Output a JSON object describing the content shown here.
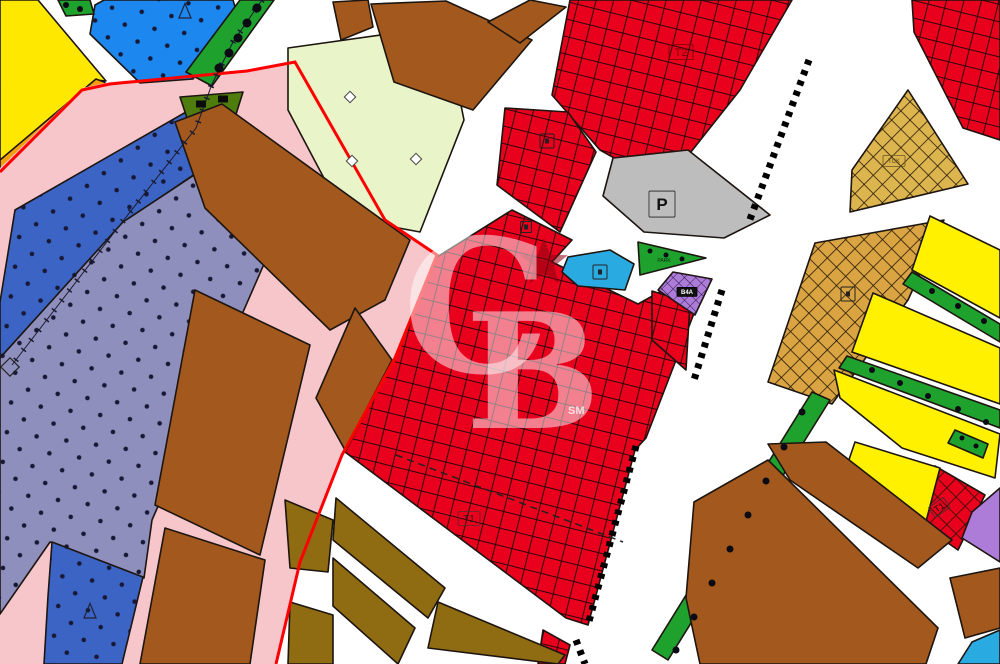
{
  "colors": {
    "road": "#ffffff",
    "outline": "#1d1510",
    "yellow": "#ffe800",
    "orange": "#f59e0b",
    "pinkzone": "#f6c6cb",
    "redline": "#ff0000",
    "blue1": "#1b87ef",
    "blue2": "#3b64c4",
    "slate": "#8f8fbe",
    "cream": "#e9f4c9",
    "brown": "#a3591d",
    "olive": "#8f6b12",
    "red": "#e8001c",
    "gray": "#bdbdbd",
    "gold": "#ddb54f",
    "tan": "#d9a441",
    "yellow2": "#fff100",
    "green": "#1fa12e",
    "dgreen": "#4e7d0e",
    "purple": "#ac7cd8",
    "cyan": "#29abe2",
    "dot": "#181835",
    "watermark": "#ffffff",
    "star": "#8a0012"
  },
  "watermark": {
    "c": "C",
    "b": "B",
    "sm": "SM"
  },
  "map": {
    "width": 1000,
    "height": 664,
    "parcels": [
      {
        "name": "parcel-yellow-nw",
        "color": "yellow",
        "points": "0,0 38,0 106,81 96,80 0,161"
      },
      {
        "name": "parcel-orange-strip",
        "color": "orange",
        "points": "104,82 108,86 8,168 0,170 0,160 96,79"
      },
      {
        "name": "parcel-pink-subject-zone",
        "color": "pinkzone",
        "stroke": "none",
        "points": "0,168 82,88 110,82 247,70 295,60 385,220 437,255 395,358 342,455 300,562 276,664 0,664"
      },
      {
        "name": "parcel-blue-dotted-north",
        "color": "blue1",
        "pattern": "dots",
        "points": "95,5 104,0 233,0 238,17 193,79 140,83 90,34"
      },
      {
        "name": "parcel-blue-dotted-band",
        "color": "blue2",
        "pattern": "dots",
        "points": "15,210 193,108 230,150 123,223 0,358 0,302"
      },
      {
        "name": "parcel-slate-dotted-zone",
        "color": "slate",
        "pattern": "dots",
        "points": "123,222 232,150 292,200 152,520 144,578 50,542 0,614 0,358"
      },
      {
        "name": "parcel-blue-dotted-south",
        "color": "blue2",
        "pattern": "dots",
        "points": "52,542 143,577 122,664 44,664 48,596"
      },
      {
        "name": "green-strip-nw-small",
        "color": "green",
        "points": "58,0 90,0 94,14 66,16"
      },
      {
        "name": "green-strip-nw",
        "color": "green",
        "points": "240,0 274,0 212,86 186,72"
      },
      {
        "name": "parcel-darkgreen-triangle",
        "color": "dgreen",
        "points": "180,97 243,92 232,127 188,121"
      },
      {
        "name": "parcel-cream",
        "color": "cream",
        "points": "288,48 445,26 464,120 420,232 345,218 288,110"
      },
      {
        "name": "parcel-brown-top-1",
        "color": "brown",
        "points": "333,2 368,0 373,27 341,40"
      },
      {
        "name": "parcel-brown-top-2",
        "color": "brown",
        "points": "371,4 446,1 532,40 473,110 394,82"
      },
      {
        "name": "parcel-brown-top-3",
        "color": "brown",
        "points": "530,0 566,7 520,43 488,22"
      },
      {
        "name": "parcel-brown-mid-1",
        "color": "brown",
        "points": "175,122 222,104 410,240 385,300 330,330 205,208"
      },
      {
        "name": "parcel-brown-mid-2",
        "color": "brown",
        "points": "195,290 310,345 260,555 155,505"
      },
      {
        "name": "parcel-brown-mid-3",
        "color": "brown",
        "points": "355,308 392,360 345,450 316,398"
      },
      {
        "name": "parcel-brown-mid-4",
        "color": "brown",
        "points": "165,528 265,560 250,664 140,664"
      },
      {
        "name": "parcel-red-commercial-t2",
        "color": "red",
        "pattern": "xred",
        "points": "570,0 792,0 740,90 664,186 600,150 552,95"
      },
      {
        "name": "parcel-red-commercial-ne",
        "color": "red",
        "pattern": "xred",
        "points": "912,0 1000,0 1000,140 963,128 914,32"
      },
      {
        "name": "parcel-red-commercial-c",
        "color": "red",
        "pattern": "xred",
        "points": "505,108 568,112 596,152 560,232 497,185"
      },
      {
        "name": "parcel-red-commercial-t1",
        "color": "red",
        "pattern": "xred",
        "points": "437,257 512,210 572,240 552,262 638,304 674,284 698,303 646,438 635,450 588,625 566,618 345,452 395,358"
      },
      {
        "name": "parcel-red-south-sliver",
        "color": "red",
        "pattern": "xred",
        "points": "543,630 570,645 565,664 538,664"
      },
      {
        "name": "parcel-red-east-small",
        "color": "red",
        "pattern": "xred",
        "points": "652,291 690,303 686,370 652,340"
      },
      {
        "name": "parcel-red-t1-triangle",
        "color": "red",
        "pattern": "xgold",
        "points": "935,466 985,495 958,550 915,520"
      },
      {
        "name": "parcel-gray-parking",
        "color": "gray",
        "points": "613,158 688,150 770,215 724,238 644,232 603,196"
      },
      {
        "name": "parcel-cyan-facility",
        "color": "cyan",
        "points": "568,257 610,250 634,264 625,290 578,286 562,272"
      },
      {
        "name": "parcel-green-park-triangle",
        "color": "green",
        "points": "638,242 706,258 640,275"
      },
      {
        "name": "parcel-purple-b4a",
        "color": "purple",
        "pattern": "xpurple",
        "points": "673,272 712,279 695,315 658,290"
      },
      {
        "name": "parcel-gold-tck",
        "color": "gold",
        "pattern": "xgold",
        "points": "908,90 968,184 850,212 852,170"
      },
      {
        "name": "parcel-tan-large",
        "color": "tan",
        "pattern": "xgold",
        "points": "815,243 944,220 908,300 832,404 768,382"
      },
      {
        "name": "parcel-yellow-east-1",
        "color": "yellow2",
        "points": "930,216 1000,250 1000,318 912,270"
      },
      {
        "name": "green-strip-e1",
        "color": "green",
        "points": "912,272 1000,324 1000,342 903,284"
      },
      {
        "name": "parcel-yellow-east-2",
        "color": "yellow2",
        "points": "873,293 1000,348 1000,404 852,352"
      },
      {
        "name": "green-strip-e2",
        "color": "green",
        "points": "847,356 1000,410 1000,428 839,368"
      },
      {
        "name": "parcel-yellow-east-3",
        "color": "yellow2",
        "points": "834,370 1000,434 995,478 902,448 840,398"
      },
      {
        "name": "green-strip-e3",
        "color": "green",
        "points": "955,430 988,444 983,458 948,443"
      },
      {
        "name": "parcel-yellow-east-4",
        "color": "yellow2",
        "points": "855,442 940,468 918,552 836,498"
      },
      {
        "name": "parcel-purple-east",
        "color": "purple",
        "points": "972,512 1000,488 1000,562 962,538"
      },
      {
        "name": "green-strip-long",
        "color": "green",
        "points": "812,392 830,400 668,660 652,650"
      },
      {
        "name": "parcel-brown-se-1",
        "color": "brown",
        "points": "768,444 826,442 952,540 918,568 790,480"
      },
      {
        "name": "parcel-brown-se-2",
        "color": "brown",
        "points": "694,502 768,460 938,628 926,664 700,664 686,598"
      },
      {
        "name": "parcel-brown-se-3",
        "color": "brown",
        "points": "950,578 1000,568 1000,628 965,638"
      },
      {
        "name": "parcel-cyan-corner",
        "color": "cyan",
        "points": "972,642 1000,630 1000,664 958,664"
      },
      {
        "name": "parcel-olive-s-1",
        "color": "olive",
        "points": "285,500 333,520 328,572 290,568"
      },
      {
        "name": "parcel-olive-s-2",
        "color": "olive",
        "points": "290,602 333,615 333,664 288,664"
      },
      {
        "name": "parcel-olive-s-3",
        "color": "olive",
        "points": "336,498 445,588 428,618 333,540"
      },
      {
        "name": "parcel-olive-s-4",
        "color": "olive",
        "points": "333,558 415,628 398,664 333,606"
      },
      {
        "name": "parcel-olive-s-5",
        "color": "olive",
        "points": "438,602 565,655 558,664 428,648"
      }
    ],
    "lines": [
      {
        "name": "plan-boundary-red",
        "color": "redline",
        "width": 3,
        "points": [
          [
            0,
            172
          ],
          [
            82,
            90
          ],
          [
            110,
            84
          ],
          [
            247,
            71
          ],
          [
            295,
            62
          ],
          [
            385,
            220
          ],
          [
            437,
            255
          ],
          [
            395,
            358
          ],
          [
            342,
            455
          ],
          [
            300,
            562
          ],
          [
            276,
            664
          ]
        ]
      },
      {
        "name": "transmission-line",
        "color": "#1a1a2e",
        "width": 1,
        "tick": true,
        "points": [
          [
            262,
            0
          ],
          [
            233,
            42
          ],
          [
            212,
            84
          ],
          [
            196,
            128
          ],
          [
            123,
            221
          ],
          [
            12,
            365
          ]
        ]
      },
      {
        "name": "ladder-road-1",
        "color": "#000000",
        "width": 7,
        "dash": "5,6",
        "points": [
          [
            809,
            60
          ],
          [
            749,
            222
          ]
        ]
      },
      {
        "name": "ladder-road-1b",
        "color": "#000000",
        "width": 7,
        "dash": "5,6",
        "points": [
          [
            722,
            290
          ],
          [
            694,
            380
          ]
        ]
      },
      {
        "name": "ladder-road-2",
        "color": "#000000",
        "width": 7,
        "dash": "5,6",
        "points": [
          [
            636,
            446
          ],
          [
            588,
            625
          ]
        ]
      },
      {
        "name": "ladder-road-2b",
        "color": "#000000",
        "width": 7,
        "dash": "5,6",
        "points": [
          [
            576,
            640
          ],
          [
            585,
            664
          ]
        ]
      },
      {
        "name": "dashed-parcel-line",
        "color": "#222222",
        "width": 1.5,
        "dash": "7,5",
        "points": [
          [
            396,
            455
          ],
          [
            623,
            542
          ]
        ]
      }
    ],
    "symbols": [
      {
        "name": "facility-box-icon",
        "type": "box",
        "x": 547,
        "y": 141,
        "s": 14
      },
      {
        "name": "facility-box-icon",
        "type": "box",
        "x": 600,
        "y": 272,
        "s": 14
      },
      {
        "name": "facility-box-icon",
        "type": "box",
        "x": 848,
        "y": 294,
        "s": 14
      },
      {
        "name": "facility-box-icon",
        "type": "box",
        "x": 526,
        "y": 227,
        "s": 11
      },
      {
        "name": "diamond-marker",
        "type": "diamond",
        "x": 350,
        "y": 97,
        "s": 8
      },
      {
        "name": "diamond-marker",
        "type": "diamond",
        "x": 416,
        "y": 159,
        "s": 8
      },
      {
        "name": "diamond-marker",
        "type": "diamond",
        "x": 352,
        "y": 161,
        "s": 8
      },
      {
        "name": "diamond-outline-marker",
        "type": "diamond-outline",
        "x": 10,
        "y": 367,
        "s": 13
      },
      {
        "name": "triangle-marker",
        "type": "triangle",
        "x": 185,
        "y": 12,
        "s": 12
      },
      {
        "name": "triangle-marker",
        "type": "triangle",
        "x": 90,
        "y": 612,
        "s": 12
      },
      {
        "name": "park-tree-dot",
        "type": "dot",
        "x": 650,
        "y": 251,
        "r": 2.5
      },
      {
        "name": "park-tree-dot",
        "type": "dot",
        "x": 666,
        "y": 255,
        "r": 2.5
      },
      {
        "name": "park-tree-dot",
        "type": "dot",
        "x": 682,
        "y": 259,
        "r": 2.5
      },
      {
        "name": "tree-dot",
        "type": "dot",
        "x": 257,
        "y": 8,
        "r": 4.5
      },
      {
        "name": "tree-dot",
        "type": "dot",
        "x": 247,
        "y": 23,
        "r": 4.5
      },
      {
        "name": "tree-dot",
        "type": "dot",
        "x": 238,
        "y": 38,
        "r": 4.5
      },
      {
        "name": "tree-dot",
        "type": "dot",
        "x": 229,
        "y": 53,
        "r": 4.5
      },
      {
        "name": "tree-dot",
        "type": "dot",
        "x": 219,
        "y": 68,
        "r": 4.5
      },
      {
        "name": "tree-dot",
        "type": "dot",
        "x": 66,
        "y": 5,
        "r": 3
      },
      {
        "name": "tree-dot",
        "type": "dot",
        "x": 80,
        "y": 9,
        "r": 3
      },
      {
        "name": "building-rect",
        "type": "rect",
        "x": 201,
        "y": 104,
        "w": 10,
        "h": 7
      },
      {
        "name": "building-rect",
        "type": "rect",
        "x": 223,
        "y": 99,
        "w": 10,
        "h": 7
      },
      {
        "name": "tree-dot",
        "type": "dot",
        "x": 932,
        "y": 291,
        "r": 3
      },
      {
        "name": "tree-dot",
        "type": "dot",
        "x": 958,
        "y": 306,
        "r": 3
      },
      {
        "name": "tree-dot",
        "type": "dot",
        "x": 984,
        "y": 321,
        "r": 3
      },
      {
        "name": "tree-dot",
        "type": "dot",
        "x": 872,
        "y": 370,
        "r": 3
      },
      {
        "name": "tree-dot",
        "type": "dot",
        "x": 900,
        "y": 383,
        "r": 3
      },
      {
        "name": "tree-dot",
        "type": "dot",
        "x": 928,
        "y": 396,
        "r": 3
      },
      {
        "name": "tree-dot",
        "type": "dot",
        "x": 958,
        "y": 409,
        "r": 3
      },
      {
        "name": "tree-dot",
        "type": "dot",
        "x": 986,
        "y": 422,
        "r": 3
      },
      {
        "name": "tree-dot",
        "type": "dot",
        "x": 802,
        "y": 412,
        "r": 3.5
      },
      {
        "name": "tree-dot",
        "type": "dot",
        "x": 784,
        "y": 447,
        "r": 3.5
      },
      {
        "name": "tree-dot",
        "type": "dot",
        "x": 766,
        "y": 481,
        "r": 3.5
      },
      {
        "name": "tree-dot",
        "type": "dot",
        "x": 748,
        "y": 515,
        "r": 3.5
      },
      {
        "name": "tree-dot",
        "type": "dot",
        "x": 730,
        "y": 549,
        "r": 3.5
      },
      {
        "name": "tree-dot",
        "type": "dot",
        "x": 712,
        "y": 583,
        "r": 3.5
      },
      {
        "name": "tree-dot",
        "type": "dot",
        "x": 694,
        "y": 617,
        "r": 3.5
      },
      {
        "name": "tree-dot",
        "type": "dot",
        "x": 676,
        "y": 650,
        "r": 3.5
      },
      {
        "name": "tree-dot",
        "type": "dot",
        "x": 962,
        "y": 438,
        "r": 2.5
      },
      {
        "name": "tree-dot",
        "type": "dot",
        "x": 976,
        "y": 446,
        "r": 2.5
      },
      {
        "name": "watermark-star",
        "type": "star",
        "x": 544,
        "y": 263,
        "r": 25,
        "color": "star",
        "opacity": 0.55
      }
    ],
    "labels": [
      {
        "name": "zone-label-t2",
        "text": "T2",
        "x": 681,
        "y": 56,
        "fs": 11,
        "color": "#7a0000",
        "box": {
          "w": 24,
          "h": 15,
          "stroke": "#7a0000"
        }
      },
      {
        "name": "zone-label-parking",
        "text": "P",
        "x": 662,
        "y": 210,
        "fs": 17,
        "color": "#111111",
        "bold": true,
        "box": {
          "w": 26,
          "h": 26,
          "stroke": "#222222"
        }
      },
      {
        "name": "zone-label-t1",
        "text": "T1",
        "x": 469,
        "y": 522,
        "fs": 10,
        "color": "#33171b",
        "box": {
          "w": 22,
          "h": 14,
          "stroke": "#5a2a2a"
        }
      },
      {
        "name": "zone-label-t1-small",
        "text": "T1",
        "x": 941,
        "y": 510,
        "fs": 9,
        "color": "#111111",
        "rot": -35,
        "box": {
          "w": 18,
          "h": 12,
          "stroke": "#333333"
        }
      },
      {
        "name": "zone-label-b4a",
        "text": "B4A",
        "x": 687,
        "y": 294,
        "fs": 6,
        "color": "#ffffff",
        "bold": true,
        "box": {
          "w": 20,
          "h": 9,
          "stroke": "#000000",
          "fill": "#111111"
        }
      },
      {
        "name": "zone-label-tck",
        "text": "TCK",
        "x": 894,
        "y": 163,
        "fs": 6,
        "color": "#5a4a10",
        "box": {
          "w": 22,
          "h": 11,
          "stroke": "#6a5a20"
        }
      },
      {
        "name": "zone-label-park",
        "text": "PARK",
        "x": 664,
        "y": 262,
        "fs": 5,
        "color": "#102a10"
      }
    ]
  }
}
